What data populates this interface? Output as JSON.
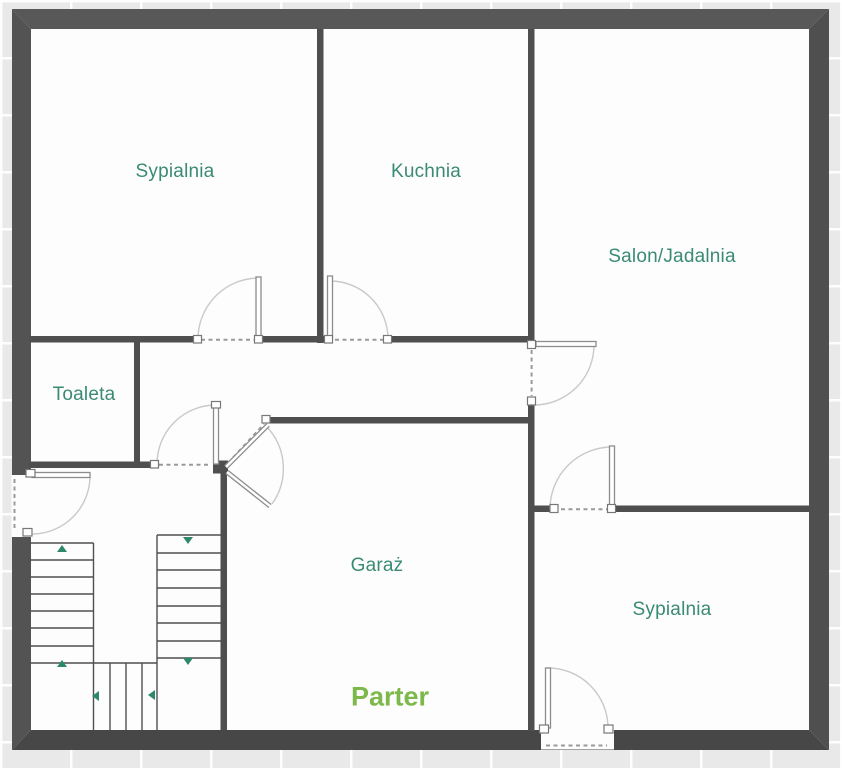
{
  "floor_plan": {
    "floor_label": "Parter",
    "rooms": [
      {
        "name": "Sypialnia"
      },
      {
        "name": "Kuchnia"
      },
      {
        "name": "Salon/Jadalnia"
      },
      {
        "name": "Toaleta"
      },
      {
        "name": "Garaż"
      },
      {
        "name": "Sypialnia"
      }
    ],
    "colors": {
      "room_label": "#3a8a74",
      "floor_label": "#7cb84a",
      "wall": "#4f4f4f",
      "door_leaf": "#8c8c8c",
      "door_arc": "#c9c9c9",
      "door_dash": "#9a9a9a",
      "stair_arrow": "#2d8968",
      "floor_fill": "#fdfdfd",
      "background_tile": "#e9e9e9",
      "tile_grout": "#ffffff"
    }
  }
}
